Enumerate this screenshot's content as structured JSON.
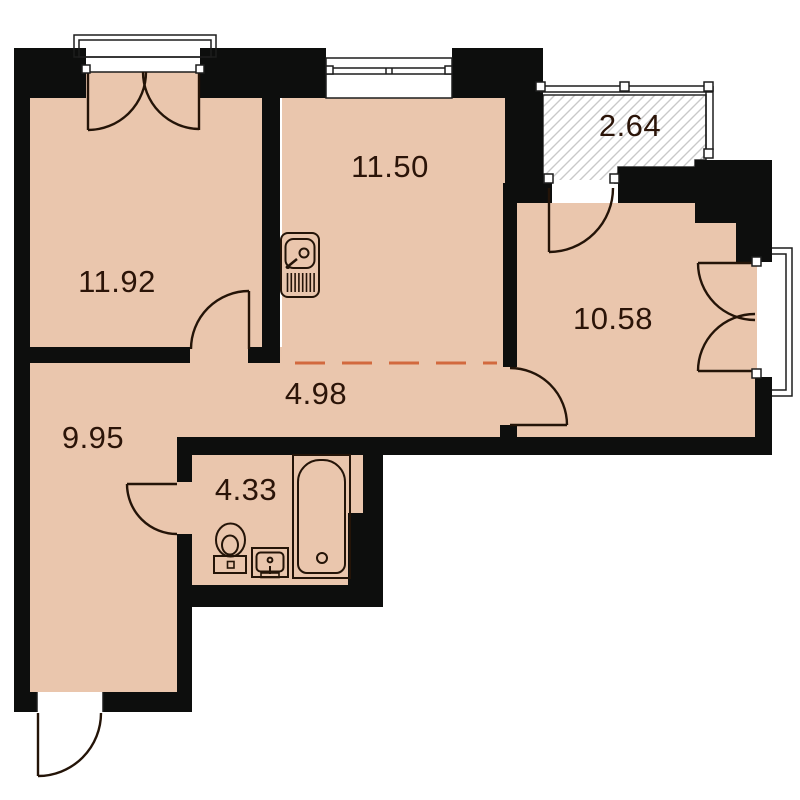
{
  "plan": {
    "title": "apartment-floor-plan",
    "rooms": [
      {
        "name": "room-top-left",
        "area": "11.92"
      },
      {
        "name": "kitchen-living",
        "area": "11.50"
      },
      {
        "name": "balcony-hatched",
        "area": "2.64"
      },
      {
        "name": "room-right",
        "area": "10.58"
      },
      {
        "name": "hallway",
        "area": "4.98"
      },
      {
        "name": "room-bottom-left",
        "area": "9.95"
      },
      {
        "name": "bathroom",
        "area": "4.33"
      }
    ],
    "icons": [
      "kitchen-sink-icon",
      "toilet-icon",
      "washbasin-icon",
      "bathtub-icon"
    ],
    "colors": {
      "wall": "#0d0e0d",
      "floor": "#eac6ad",
      "background": "#ffffff",
      "detail_stroke": "#241408",
      "thin_stroke": "#1d1d1d",
      "hatch_line": "#c9c9c9",
      "zone_dashed_line": "#d2693e",
      "label_text": "#2b1408"
    }
  }
}
